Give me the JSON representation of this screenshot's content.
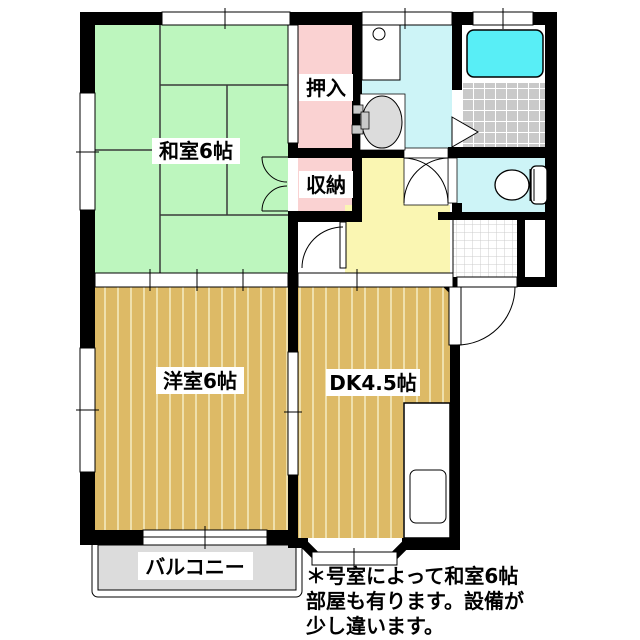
{
  "plan": {
    "rooms": {
      "washitsu": "和室6帖",
      "oshiire": "押入",
      "shuunou": "収納",
      "youshitsu": "洋室6帖",
      "dk": "DK4.5帖",
      "balcony": "バルコニー"
    },
    "note": {
      "line1": "＊号室によって和室6帖",
      "line2": "部屋も有ります。設備が",
      "line3": "少し違います。"
    },
    "colors": {
      "tatami_green": "#BDF6BE",
      "closet_pink": "#FAD2D2",
      "water_cyan": "#CDF4F7",
      "bathtub_cyan": "#58EEF6",
      "hall_yellow": "#FAF6B2",
      "wood_tan": "#DDBA66",
      "wood_stripe": "#EFE0AC",
      "tile_gray": "#C9C9C9",
      "balcony_gray": "#DCDCDC",
      "wall_black": "#000000"
    }
  }
}
